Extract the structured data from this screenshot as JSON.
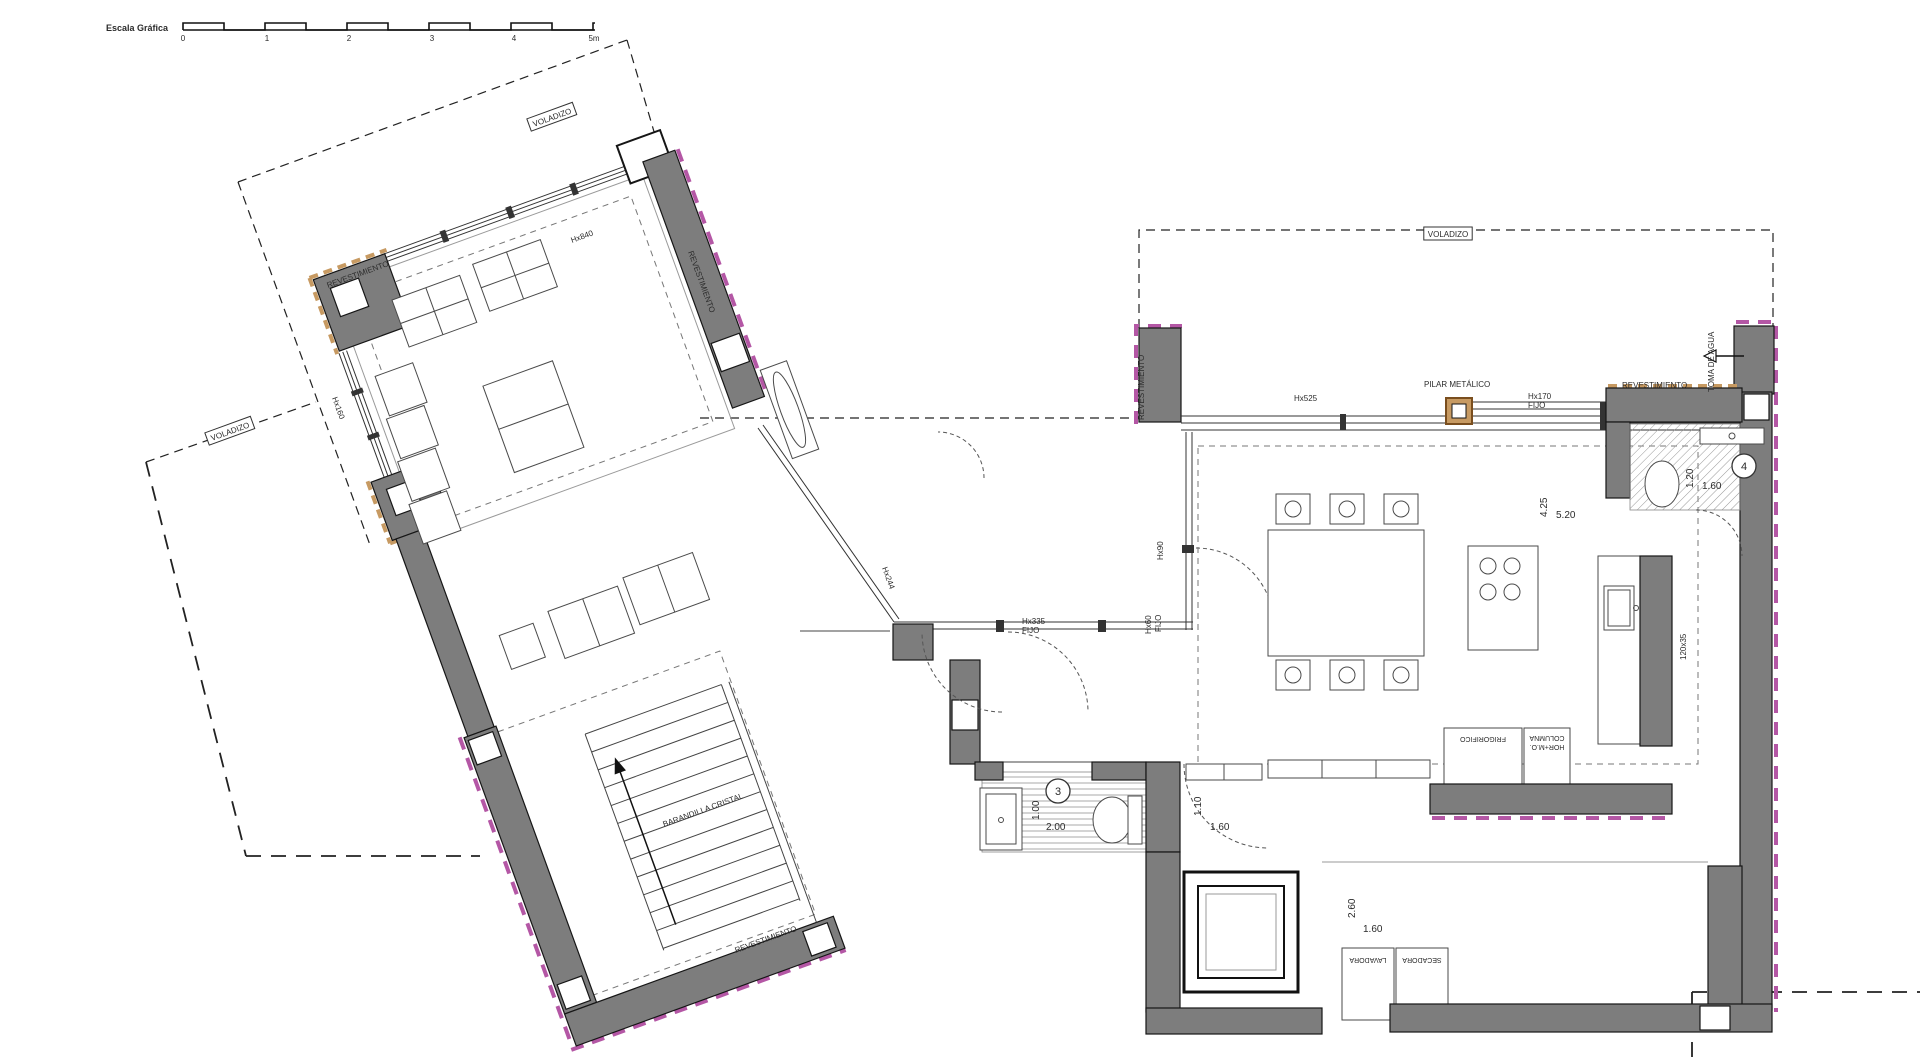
{
  "document": {
    "type": "architectural-floor-plan",
    "language": "es"
  },
  "colors": {
    "wall_gray": "#7d7d7d",
    "cladding_magenta": "#b457a5",
    "cladding_tan": "#c79a62",
    "line_black": "#161616",
    "background": "#ffffff"
  },
  "scale_bar": {
    "title": "Escala Gráfica",
    "ticks": [
      "0",
      "1",
      "2",
      "3",
      "4",
      "5m"
    ]
  },
  "labels": [
    {
      "id": "scale-title",
      "t": "Escala Gráfica",
      "x": 106,
      "y": 31,
      "s": 9,
      "b": 1
    },
    {
      "id": "scale-tick-0",
      "t": "0",
      "x": 183,
      "y": 41,
      "s": 8,
      "m": 1
    },
    {
      "id": "scale-tick-1",
      "t": "1",
      "x": 267,
      "y": 41,
      "s": 8,
      "m": 1
    },
    {
      "id": "scale-tick-2",
      "t": "2",
      "x": 349,
      "y": 41,
      "s": 8,
      "m": 1
    },
    {
      "id": "scale-tick-3",
      "t": "3",
      "x": 432,
      "y": 41,
      "s": 8,
      "m": 1
    },
    {
      "id": "scale-tick-4",
      "t": "4",
      "x": 514,
      "y": 41,
      "s": 8,
      "m": 1
    },
    {
      "id": "scale-tick-5",
      "t": "5m",
      "x": 594,
      "y": 41,
      "s": 8,
      "m": 1
    },
    {
      "id": "voladizo-top-left",
      "t": "VOLADIZO",
      "x": 553,
      "y": 120,
      "r": -20,
      "s": 8,
      "box": 1
    },
    {
      "id": "voladizo-mid-left",
      "t": "VOLADIZO",
      "x": 231,
      "y": 434,
      "r": -20,
      "s": 8,
      "box": 1
    },
    {
      "id": "voladizo-right",
      "t": "VOLADIZO",
      "x": 1448,
      "y": 237,
      "s": 8,
      "box": 1
    },
    {
      "id": "revestimiento-top-left",
      "t": "REVESTIMIENTO",
      "x": 328,
      "y": 288,
      "r": -20,
      "s": 8
    },
    {
      "id": "revestimiento-angled-wall",
      "t": "REVESTIMIENTO",
      "x": 688,
      "y": 252,
      "r": 70,
      "s": 8
    },
    {
      "id": "revestimiento-bottom",
      "t": "REVESTIMIENTO",
      "x": 736,
      "y": 953,
      "r": -20,
      "s": 8
    },
    {
      "id": "revestimiento-pier",
      "t": "REVESTIMIENTO",
      "x": 1144,
      "y": 420,
      "r": -90,
      "s": 8
    },
    {
      "id": "revestimiento-right",
      "t": "REVESTIMIENTO",
      "x": 1622,
      "y": 388,
      "s": 8
    },
    {
      "id": "toma-de-agua",
      "t": "TOMA DE AGUA",
      "x": 1714,
      "y": 392,
      "r": -90,
      "s": 8
    },
    {
      "id": "pilar-metalico",
      "t": "PILAR METÁLICO",
      "x": 1424,
      "y": 387,
      "s": 8
    },
    {
      "id": "window-label-hx525",
      "t": "Hx525",
      "x": 1294,
      "y": 401,
      "s": 8
    },
    {
      "id": "window-label-hx170",
      "t": "Hx170",
      "x": 1528,
      "y": 399,
      "s": 8
    },
    {
      "id": "window-label-fijo-1",
      "t": "FIJO",
      "x": 1528,
      "y": 408,
      "s": 8
    },
    {
      "id": "window-label-hx335",
      "t": "Hx335",
      "x": 1022,
      "y": 624,
      "s": 8
    },
    {
      "id": "window-label-fijo-2",
      "t": "FIJO",
      "x": 1022,
      "y": 633,
      "s": 8
    },
    {
      "id": "window-label-hx90",
      "t": "Hx90",
      "x": 1163,
      "y": 560,
      "r": -90,
      "s": 8
    },
    {
      "id": "window-label-hx60",
      "t": "Hx60",
      "x": 1151,
      "y": 634,
      "r": -90,
      "s": 8
    },
    {
      "id": "window-label-fijo-3",
      "t": "FIJO",
      "x": 1161,
      "y": 632,
      "r": -90,
      "s": 8
    },
    {
      "id": "window-label-hx244",
      "t": "Hx244",
      "x": 882,
      "y": 568,
      "r": 70,
      "s": 8
    },
    {
      "id": "window-label-hx160",
      "t": "Hx160",
      "x": 332,
      "y": 398,
      "r": 70,
      "s": 8
    },
    {
      "id": "window-label-hx840",
      "t": "Hx840",
      "x": 572,
      "y": 243,
      "r": -20,
      "s": 8
    },
    {
      "id": "dim-bath4-depth",
      "t": "1.20",
      "x": 1693,
      "y": 488,
      "r": -90,
      "s": 10
    },
    {
      "id": "dim-bath4-width",
      "t": "1.60",
      "x": 1702,
      "y": 489,
      "s": 10
    },
    {
      "id": "room-number-4",
      "t": "4",
      "x": 1744,
      "y": 470,
      "s": 11,
      "circle": 1
    },
    {
      "id": "dim-kitchen-depth",
      "t": "4.25",
      "x": 1547,
      "y": 517,
      "r": -90,
      "s": 10
    },
    {
      "id": "dim-kitchen-width",
      "t": "5.20",
      "x": 1556,
      "y": 518,
      "s": 10
    },
    {
      "id": "dim-bath3-depth",
      "t": "1.00",
      "x": 1039,
      "y": 820,
      "r": -90,
      "s": 10
    },
    {
      "id": "dim-bath3-width",
      "t": "2.00",
      "x": 1046,
      "y": 830,
      "s": 10
    },
    {
      "id": "room-number-3",
      "t": "3",
      "x": 1058,
      "y": 795,
      "s": 11,
      "circle": 1
    },
    {
      "id": "dim-hall-depth",
      "t": "1.10",
      "x": 1201,
      "y": 816,
      "r": -90,
      "s": 10
    },
    {
      "id": "dim-hall-width",
      "t": "1.60",
      "x": 1210,
      "y": 830,
      "s": 10
    },
    {
      "id": "dim-laundry-depth",
      "t": "2.60",
      "x": 1355,
      "y": 918,
      "r": -90,
      "s": 10
    },
    {
      "id": "dim-laundry-width",
      "t": "1.60",
      "x": 1363,
      "y": 932,
      "s": 10
    },
    {
      "id": "stair-railing-label",
      "t": "BARANDILLA CRISTAL",
      "x": 664,
      "y": 827,
      "r": -20,
      "s": 8
    },
    {
      "id": "appliance-lavadora",
      "t": "LAVADORA",
      "x": 1368,
      "y": 958,
      "r": 180,
      "s": 7,
      "m": 1
    },
    {
      "id": "appliance-secadora",
      "t": "SECADORA",
      "x": 1422,
      "y": 958,
      "r": 180,
      "s": 7,
      "m": 1
    },
    {
      "id": "appliance-frigorifico",
      "t": "FRIGORIFICO",
      "x": 1483,
      "y": 737,
      "r": 180,
      "s": 7,
      "m": 1
    },
    {
      "id": "appliance-columna-1",
      "t": "COLUMNA",
      "x": 1547,
      "y": 736,
      "r": 180,
      "s": 7,
      "m": 1
    },
    {
      "id": "appliance-columna-2",
      "t": "HOR+M.O.",
      "x": 1547,
      "y": 745,
      "r": 180,
      "s": 7,
      "m": 1
    },
    {
      "id": "counter-note",
      "t": "120x35",
      "x": 1686,
      "y": 660,
      "r": -90,
      "s": 8
    }
  ]
}
